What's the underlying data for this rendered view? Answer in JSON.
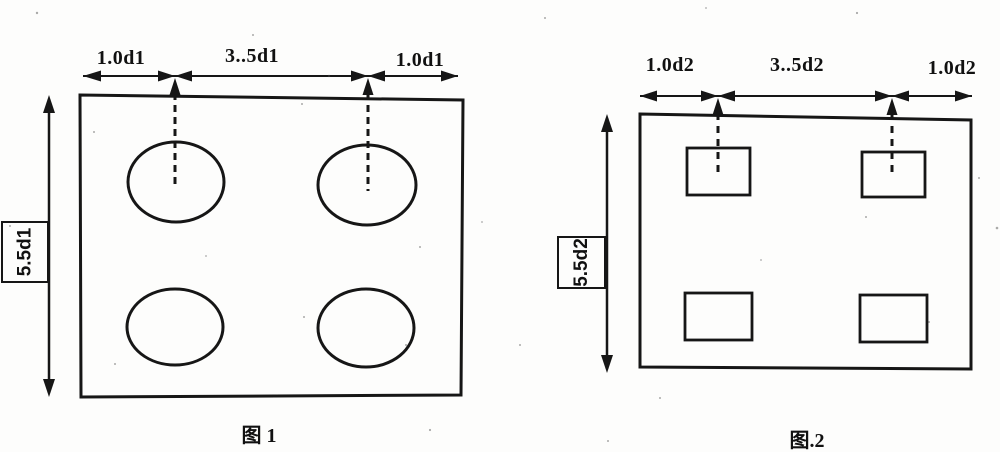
{
  "colors": {
    "ink": "#161616",
    "background": "#fdfdfc"
  },
  "figure1": {
    "dim_top_left": "1.0d1",
    "dim_top_middle": "3..5d1",
    "dim_top_right": "1.0d1",
    "dim_side": "5.5d1",
    "caption": "图 1"
  },
  "figure2": {
    "dim_top_left": "1.0d2",
    "dim_top_middle": "3..5d2",
    "dim_top_right": "1.0d2",
    "dim_side": "5.5d2",
    "caption": "图.2"
  }
}
